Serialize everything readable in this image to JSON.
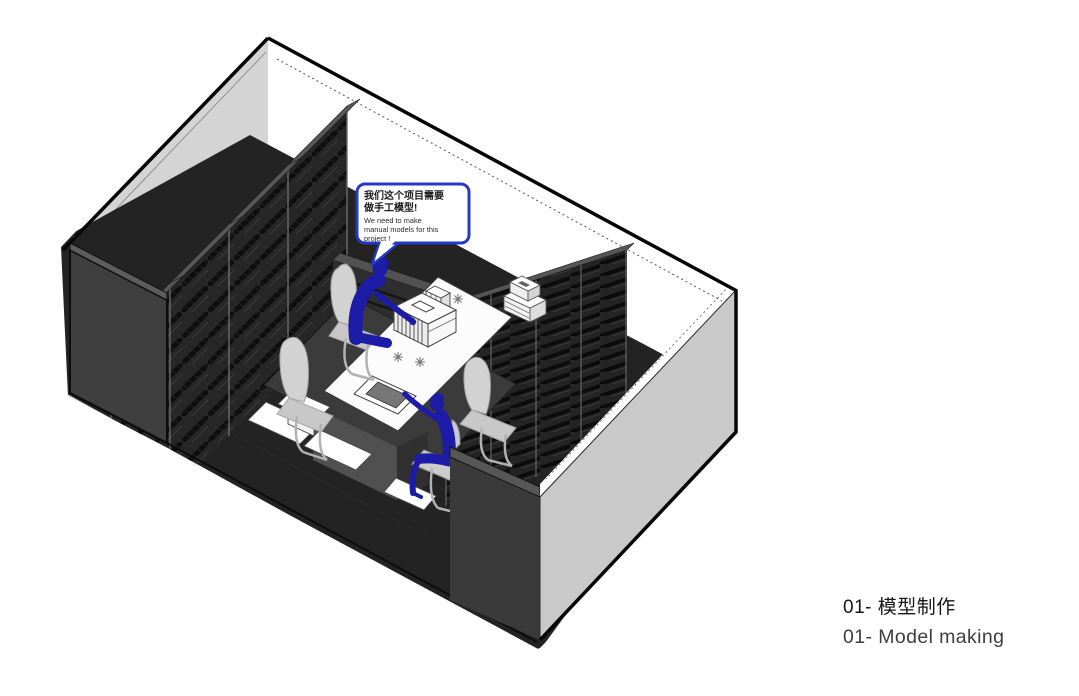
{
  "page": {
    "background": "#ffffff"
  },
  "speech_bubble": {
    "zh": [
      "我们这个项目需要",
      "做手工模型!"
    ],
    "en": [
      "We need to make",
      "manual models for this",
      "project !"
    ]
  },
  "caption": {
    "line1_zh": "01- 模型制作",
    "line2_en": "01- Model making"
  },
  "colors": {
    "figure_blue": "#1c1ca6",
    "bubble_border": "#2638c8",
    "wall_light_interior": "#d4d4d4",
    "wall_exterior_gray": "#c9c9c9",
    "wall_dark": "#3d3d3d",
    "floor_dark": "#232323",
    "shelf_dark": "#262626",
    "chair_gray": "#d0d0d0",
    "caption_zh_color": "#151515",
    "caption_en_color": "#3e3e3e"
  }
}
